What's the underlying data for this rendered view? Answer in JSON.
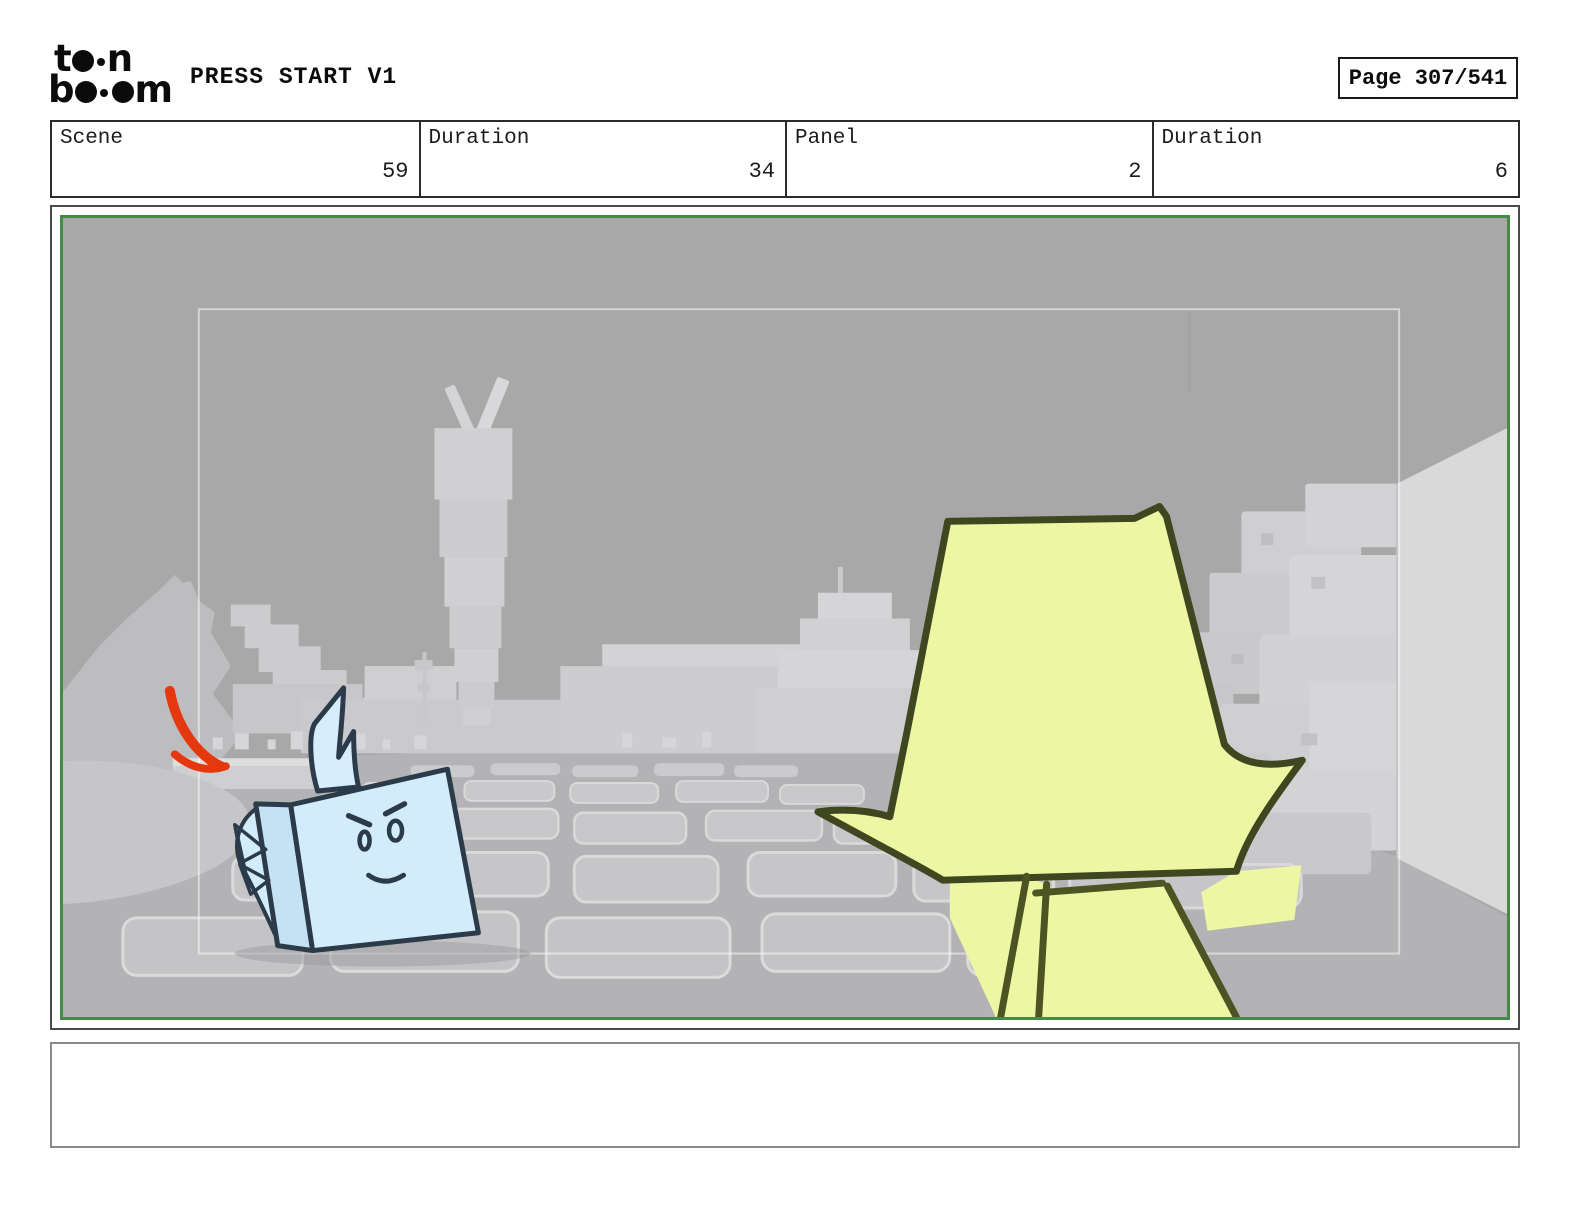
{
  "header": {
    "title": "PRESS START V1",
    "page_label": "Page 307/541"
  },
  "logo": {
    "alt": "toon boom",
    "l1a": "t",
    "l1c": "n",
    "l2a": "b",
    "l2c": "m"
  },
  "info_row": {
    "cells": [
      {
        "label": "Scene",
        "value": "59"
      },
      {
        "label": "Duration",
        "value": "34"
      },
      {
        "label": "Panel",
        "value": "2"
      },
      {
        "label": "Duration",
        "value": "6"
      }
    ]
  },
  "caption": {
    "text": ""
  },
  "colors": {
    "panel_border_green": "#478a47",
    "render_sky_gray": "#a8a8a8",
    "sketch_blue_fill": "#d3ecfb",
    "sketch_blue_line": "#2c3b49",
    "sketch_yellow_fill": "#edf7a3",
    "sketch_yellow_line": "#3e471f",
    "annotation_red": "#e5380f"
  }
}
